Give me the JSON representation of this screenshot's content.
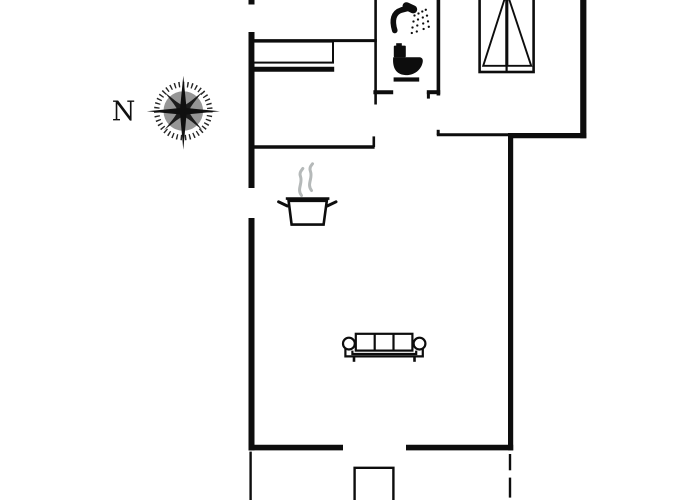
{
  "plan": {
    "type": "holiday-house-floor-plan",
    "compass": {
      "label": "N"
    },
    "colors": {
      "background": "#ffffff",
      "wall": "#0d0d0d",
      "icon": "#0d0d0d",
      "steam": "#b5b9b9",
      "compass_disc": "#969696",
      "compass_star": "#2b2b2b",
      "compass_ring": "#262626"
    },
    "icons": [
      {
        "name": "compass-rose-icon"
      },
      {
        "name": "shower-icon"
      },
      {
        "name": "toilet-icon"
      },
      {
        "name": "double-bed-icon"
      },
      {
        "name": "cooking-pot-icon"
      },
      {
        "name": "steam-icon"
      },
      {
        "name": "sofa-icon"
      }
    ],
    "features": [
      "exterior-walls",
      "interior-walls",
      "kitchen-counter",
      "door-openings",
      "entrance-step",
      "terrace-boundary-dashed"
    ]
  }
}
